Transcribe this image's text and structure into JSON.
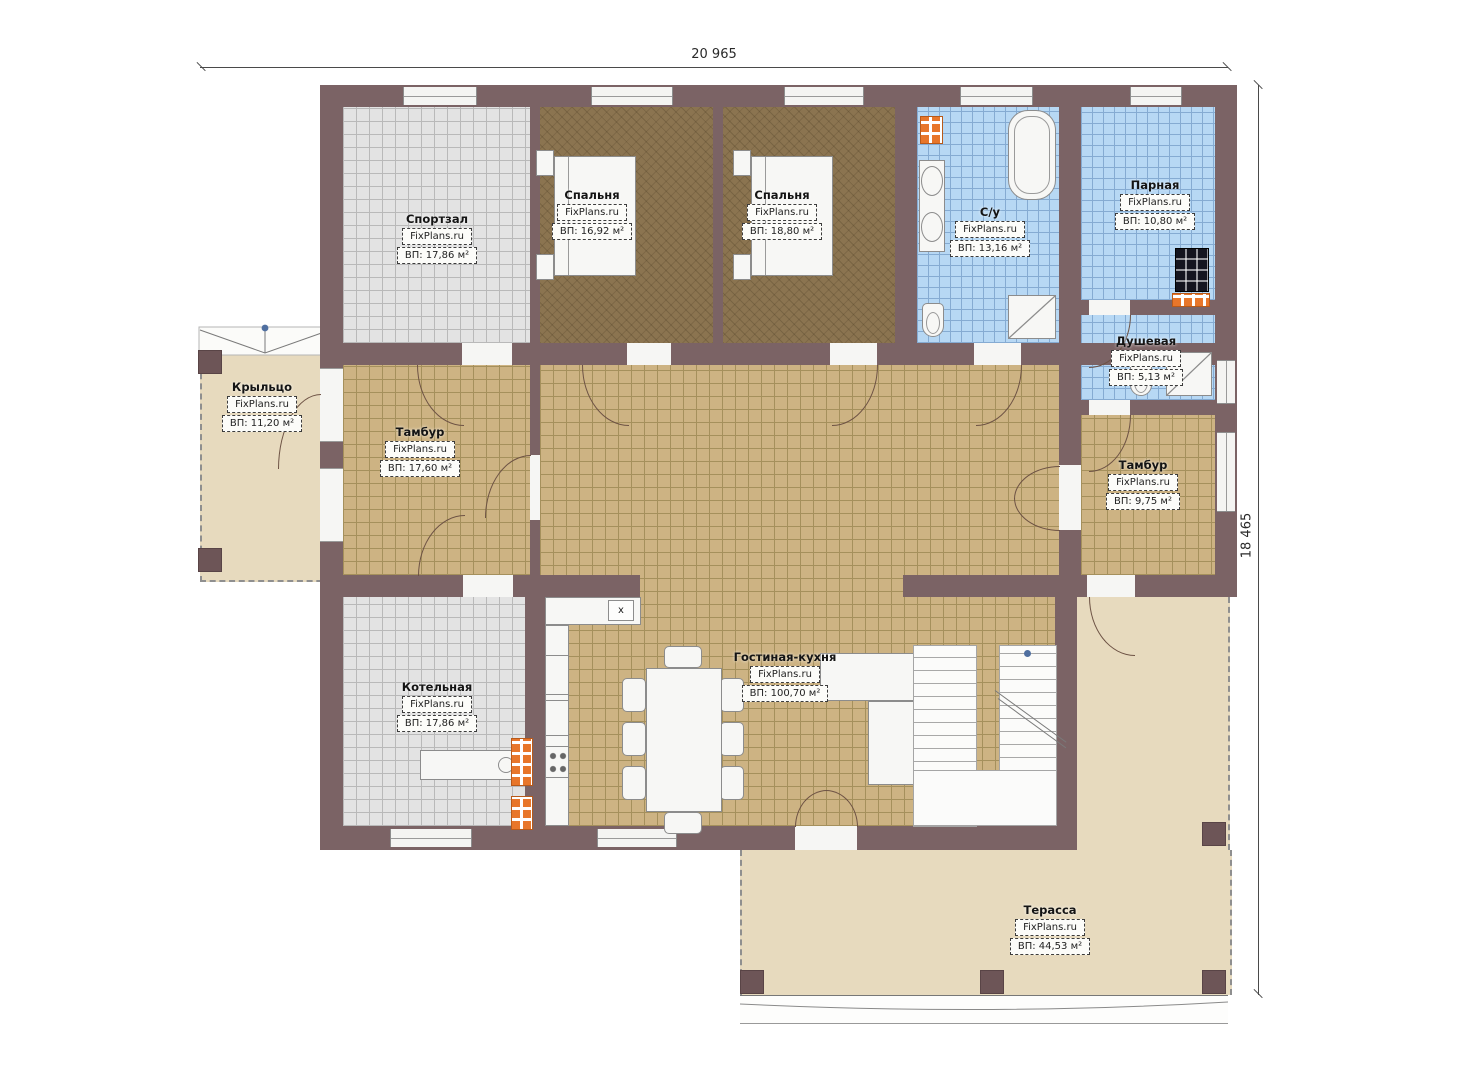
{
  "dimensions": {
    "width_label": "20 965",
    "height_label": "18 465"
  },
  "brand": "FixPlans.ru",
  "rooms": {
    "sportzal": {
      "name": "Спортзал",
      "area": "ВП: 17,86 м²"
    },
    "bedroom1": {
      "name": "Спальня",
      "area": "ВП: 16,92 м²"
    },
    "bedroom2": {
      "name": "Спальня",
      "area": "ВП: 18,80 м²"
    },
    "su": {
      "name": "С/у",
      "area": "ВП: 13,16 м²"
    },
    "parnaya": {
      "name": "Парная",
      "area": "ВП: 10,80 м²"
    },
    "dushevaya": {
      "name": "Душевая",
      "area": "ВП: 5,13 м²"
    },
    "kryltso": {
      "name": "Крыльцо",
      "area": "ВП: 11,20 м²"
    },
    "tambur1": {
      "name": "Тамбур",
      "area": "ВП: 17,60 м²"
    },
    "tambur2": {
      "name": "Тамбур",
      "area": "ВП: 9,75 м²"
    },
    "kotelnaya": {
      "name": "Котельная",
      "area": "ВП: 17,86 м²"
    },
    "living": {
      "name": "Гостиная-кухня",
      "area": "ВП: 100,70 м²"
    },
    "terrace": {
      "name": "Терасса",
      "area": "ВП: 44,53 м²"
    }
  },
  "kitchen": {
    "vent_label": "х"
  },
  "colors": {
    "wall": "#7b6365",
    "tile_tan": "#cdb383",
    "tile_gray": "#e3e3e3",
    "tile_blue": "#b7d8f4",
    "floor_bedroom": "#8b7450",
    "outdoor_beige": "#e7dabe",
    "accent_orange": "#e8762a"
  }
}
